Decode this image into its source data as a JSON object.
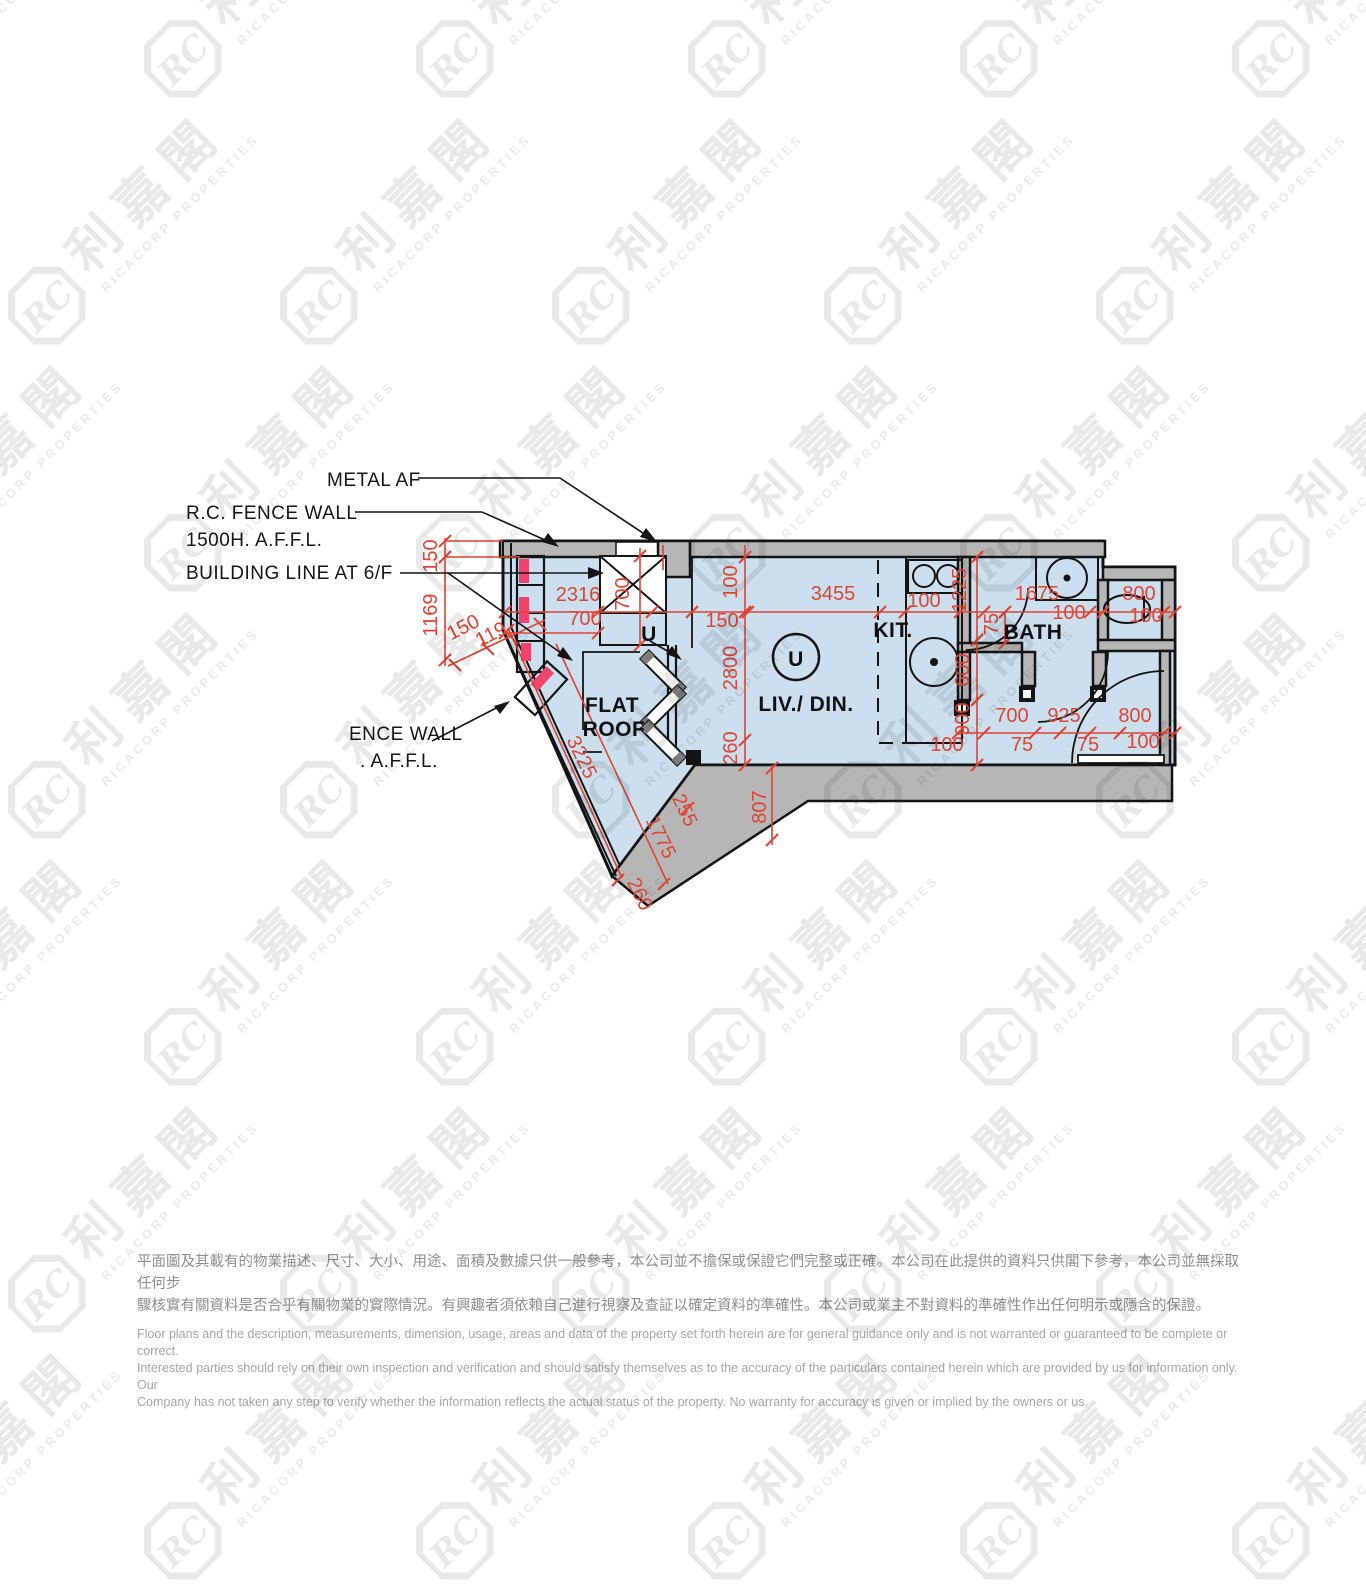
{
  "watermark": {
    "monogram": "RC",
    "chinese": "利嘉閣",
    "english": "RICACORP PROPERTIES"
  },
  "plan": {
    "callouts": {
      "metal_af": "METAL AF",
      "fence_wall_line1": "R.C. FENCE WALL",
      "fence_wall_line2": "1500H. A.F.F.L.",
      "building_line": "BUILDING LINE AT 6/F",
      "ence_wall_line1": "ENCE WALL",
      "ence_wall_line2": ". A.F.F.L."
    },
    "rooms": {
      "flat_roof_line1": "FLAT",
      "flat_roof_line2": "ROOF",
      "living": "LIV./ DIN.",
      "kitchen": "KIT.",
      "bath": "BATH"
    },
    "unit_label": "U",
    "entrance_label": "U",
    "dimension_labels": [
      {
        "text": "150",
        "x": 437,
        "y": 556,
        "rot": -90
      },
      {
        "text": "1169",
        "x": 437,
        "y": 615,
        "rot": -90
      },
      {
        "text": "150",
        "x": 466,
        "y": 633,
        "rot": -27
      },
      {
        "text": "119",
        "x": 494,
        "y": 640,
        "rot": -27
      },
      {
        "text": "2316",
        "x": 578,
        "y": 601,
        "rot": 0
      },
      {
        "text": "700",
        "x": 585,
        "y": 625,
        "rot": 0
      },
      {
        "text": "700",
        "x": 629,
        "y": 594,
        "rot": -90
      },
      {
        "text": "3455",
        "x": 833,
        "y": 600,
        "rot": 0
      },
      {
        "text": "150",
        "x": 722,
        "y": 627,
        "rot": 0
      },
      {
        "text": "100",
        "x": 737,
        "y": 582,
        "rot": -90
      },
      {
        "text": "2800",
        "x": 737,
        "y": 668,
        "rot": -90
      },
      {
        "text": "260",
        "x": 737,
        "y": 748,
        "rot": -90
      },
      {
        "text": "100",
        "x": 924,
        "y": 607,
        "rot": 0
      },
      {
        "text": "1225",
        "x": 966,
        "y": 590,
        "rot": -90
      },
      {
        "text": "1675",
        "x": 1037,
        "y": 600,
        "rot": 0
      },
      {
        "text": "800",
        "x": 1139,
        "y": 600,
        "rot": 0
      },
      {
        "text": "100",
        "x": 1069,
        "y": 619,
        "rot": 0
      },
      {
        "text": "100",
        "x": 1146,
        "y": 622,
        "rot": 0
      },
      {
        "text": "75",
        "x": 998,
        "y": 624,
        "rot": -90
      },
      {
        "text": "600",
        "x": 969,
        "y": 670,
        "rot": -90
      },
      {
        "text": "900",
        "x": 969,
        "y": 719,
        "rot": -90
      },
      {
        "text": "700",
        "x": 1012,
        "y": 722,
        "rot": 0
      },
      {
        "text": "925",
        "x": 1064,
        "y": 722,
        "rot": 0
      },
      {
        "text": "800",
        "x": 1135,
        "y": 722,
        "rot": 0
      },
      {
        "text": "100",
        "x": 947,
        "y": 751,
        "rot": 0
      },
      {
        "text": "75",
        "x": 1022,
        "y": 751,
        "rot": 0
      },
      {
        "text": "75",
        "x": 1088,
        "y": 751,
        "rot": 0
      },
      {
        "text": "100",
        "x": 1143,
        "y": 748,
        "rot": 0
      },
      {
        "text": "807",
        "x": 766,
        "y": 807,
        "rot": -90
      },
      {
        "text": "255",
        "x": 679,
        "y": 813,
        "rot": 64
      },
      {
        "text": "1775",
        "x": 655,
        "y": 840,
        "rot": 64
      },
      {
        "text": "260",
        "x": 634,
        "y": 897,
        "rot": 64
      },
      {
        "text": "3225",
        "x": 576,
        "y": 760,
        "rot": 64
      }
    ]
  },
  "disclaimer": {
    "chinese": [
      "平面圖及其載有的物業描述、尺寸、大小、用途、面積及數據只供一般參考，本公司並不擔保或保證它們完整或正確。本公司在此提供的資料只供閣下參考，本公司並無採取任何步",
      "驟核實有關資料是否合乎有關物業的實際情況。有興趣者須依賴自己進行視察及查証以確定資料的準確性。本公司或業主不對資料的準確性作出任何明示或隱含的保證。"
    ],
    "english": [
      "Floor plans and the description, measurements, dimension, usage, areas and data of the property set forth herein are for general guidance only and is not warranted or guaranteed to be complete or correct.",
      "Interested parties should rely on their own inspection and verification and should satisfy themselves as to the accuracy of the particulars contained herein which are provided by us for information only.  Our",
      "Company has not taken any step to verify whether the information reflects the actual status of the property.  No warranty for accuracy is given or implied by the owners or us."
    ]
  },
  "colors": {
    "floor": "#cbdfee",
    "wall": "#b6b6b6",
    "dimension": "#e04433",
    "highlight": "#f0436e",
    "watermark": "#e9e9e9"
  }
}
